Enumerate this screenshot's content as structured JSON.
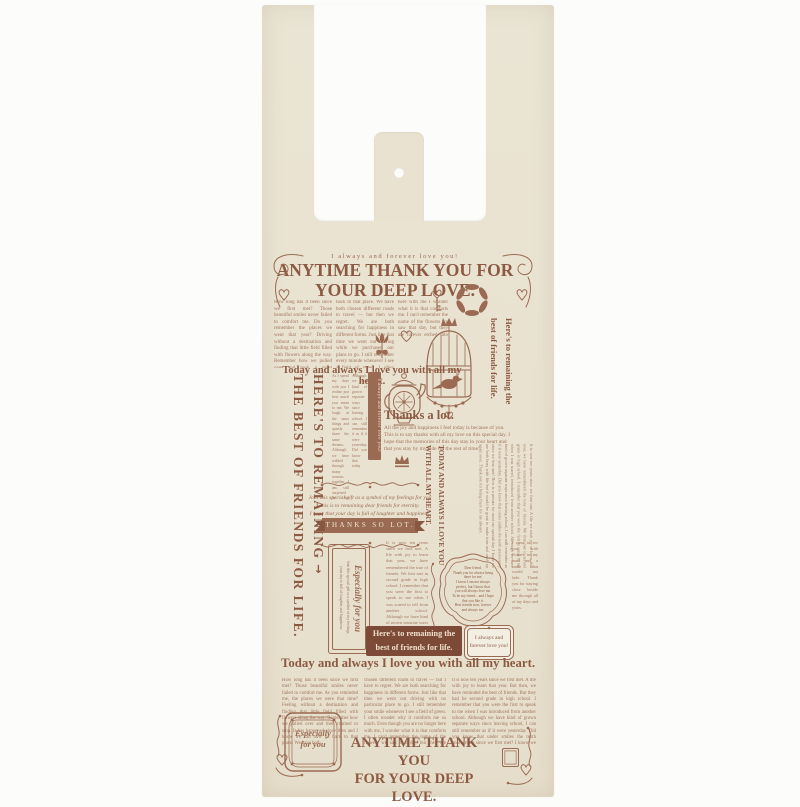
{
  "colors": {
    "background": "#fcfcfa",
    "bag_beige": "#e9e2d0",
    "print_brown": "#9a6a52",
    "headline_brown": "#8c5a43",
    "banner_fill": "#7d4a38",
    "cream_text": "#efe5d2"
  },
  "icons": {
    "arrow": "→",
    "diamond": "◆"
  },
  "bag": {
    "tagline": "I always and forever love you!",
    "headline_top_1": "ANYTIME THANK YOU FOR",
    "headline_top_2": "YOUR DEEP LOVE.",
    "mid_headline": "Today and always I love you with all my heart.",
    "left_vertical_1": "HERE'S TO REMAINING",
    "left_vertical_2": "THE BEST OF FRIENDS FOR LIFE.",
    "right_vertical_1": "Here's to remaining the",
    "right_vertical_2": "best of friends for life.",
    "ribbon_vertical": "I always and forever love you!",
    "thanks_a_lot": "Thanks a lot.",
    "thanks_paragraph": "All the joy and happiness I feel today is because of you. This is to say thanks with all my love on this special day. I hope that the memories of this day stay in your heart and that you stay by my side for the rest of time.",
    "script_lines": [
      "Join this special gift as a symbol of my feelings for you",
      "this is to remaining dear friends for eternity.",
      "I hope that your day is full of laughter and happiness."
    ],
    "banner_thanks": "THANKS SO LOT.",
    "today_vertical_1": "TODAY AND ALWAYS I LOVE YOU",
    "today_vertical_2": "WITH ALL MY HEART.",
    "especially_title": "Especially for you",
    "especially_small_1": "Join this special gift as a symbol of my feelings,",
    "especially_small_2": "your day is full of laughter and happiness.",
    "scallop_lines": [
      "Dear friend,",
      "Thank you for always being",
      "there for me.",
      "I know I am not always",
      "perfect, but I know that",
      "you will always love me.",
      "To be my friend... and I hope",
      "that you like it.",
      "Best friends now, forever",
      "and always too."
    ],
    "box_banner_1": "Here's to remaining the",
    "box_banner_2": "best of friends for life.",
    "small_badge_1": "I always and",
    "small_badge_2": "forever love you!",
    "bottom_headline": "Today and always I love you with all my heart.",
    "footer_headline_1": "ANYTIME THANK YOU",
    "footer_headline_2": "FOR YOUR DEEP LOVE.",
    "stamp_line_1": "Especially",
    "stamp_line_2": "for you",
    "columns": {
      "top": [
        "How long has it been since we first met? Those beautiful smiles never failed to comfort me. Do you remember the places we went that year? Driving without a destination and finding that little field filled with flowers along the way. Remember how we pulled over and took a quiet moment to stop. It has happened since then and I know we can never go",
        "back to that place. We have both chosen different roads to travel — but then we regret. We are both searching for happiness in different forms. Just like that time we went out driving while we purchased our plans to go. I still remember every minute whenever I see a field of green. I often wonder why it comforts me so much. Even though we are no longer",
        "here with me I wonder what it is that comforts me. I can't remember the name of the flowers we saw that day, but they are forever etched into my mind. I still hope to find that beautiful flower."
      ],
      "mid_left": [
        "As I spend my days with you I realize just how much you mean to me. We laugh at the same things and quietly share the same dreams. Although we have walked through many seasons together I am still surprised by the warmth you bring to every single day we meet and talk about little things along the way home.",
        "Although we have kind of grown separate ways since leaving school, I can still remember it as if it were yesterday. Did you know that today marks the years since we first met? I hope we can celebrate that special day together soon."
      ],
      "right_mid": "It is now ten years since we first met. A life we wish joy to leave that year, we have remembered the tone of friends. We first met in second grade in high school. I remember that you were the first to speak to me when I was scared, introduced from another school. Although we have kind of grown separate ways since leaving school, I can still remember as if it were yesterday. Did you know that under smiles the tenth anniversary since we first met? How is a private for most our special day. I know we are both busy with life but it would be great to make time and catch up again soon. Thank you for being there for me always.",
      "center": "It is now ten years since we first met. A life with joy to learn that year, we have remembered the true of friends. We first met in second grade in high school. I remember that you were the first to speak to me when I was scared to tell from another school. Although we have kind of grown separate ways since leaving school, I can still remember it as if it were yesterday.",
      "right_lower": "I came to see you with flowers in my hand and a smile that would not fade. Thank you for staying close beside me through all of my days and years.",
      "bottom": [
        "How long has it been since we first met? Those beautiful smiles never failed to comfort me. As you reminded me, the places we were that time? Feeling without a destination and finding that little field filled with flowers along the way. Remember how we pulled over and then roamed to stop. It has happened since then and I know we can now go back to that place. We have both",
        "chosen different roads to travel — but I have to regret. We are both searching for happiness in different forms. Just like that time we went out driving with no particular place to go. I still remember your smile whenever I see a field of green. I often wonder why it comforts me so much. Even though you are no longer here with me, I wonder what it is that comforts me. I can't remember the name of the flowers we saw that day but they are forever etched into my mind. I will hope to find that beautiful flower.",
        "It is now ten years since we first met. A life with joy to learn that year. But then, we have reminded the best of friends. But they had be second grade in high school. I remember that you were the first to speak to me when I was introduced from another school. Although we have kind of grown separate ways since leaving school, I can still remember as if it were yesterday. Did you know that under smiles the tenth anniversary since we first met? I know we are both busy with life but it would be great to make time and catch up again soon."
      ]
    }
  }
}
